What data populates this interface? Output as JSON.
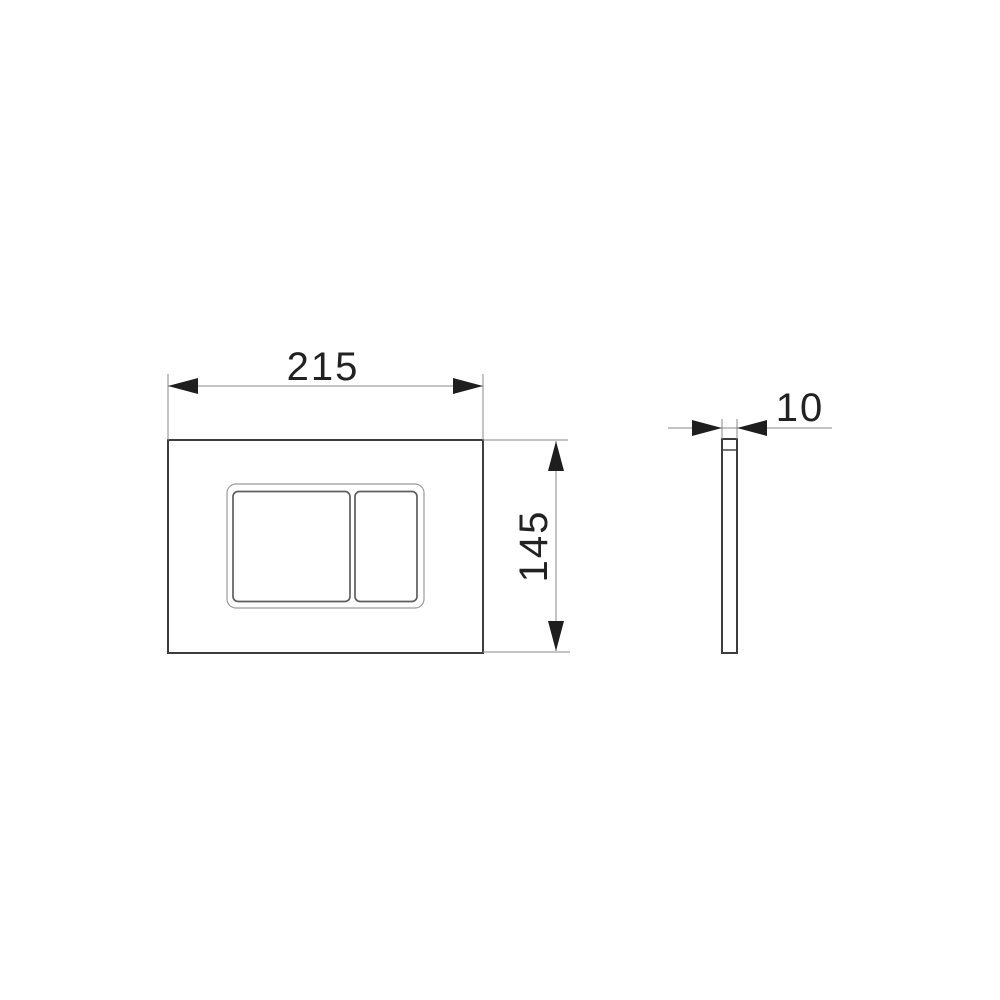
{
  "drawing": {
    "dimension_labels": {
      "width": "215",
      "height": "145",
      "depth": "10"
    },
    "colors": {
      "object_line": "#3d3d3d",
      "frame_line": "#9b9b9b",
      "button_line": "#5f5f5f",
      "dimension_line": "#8a8a8a",
      "arrow": "#1e1e1e",
      "text": "#222222",
      "background": "#ffffff"
    }
  }
}
